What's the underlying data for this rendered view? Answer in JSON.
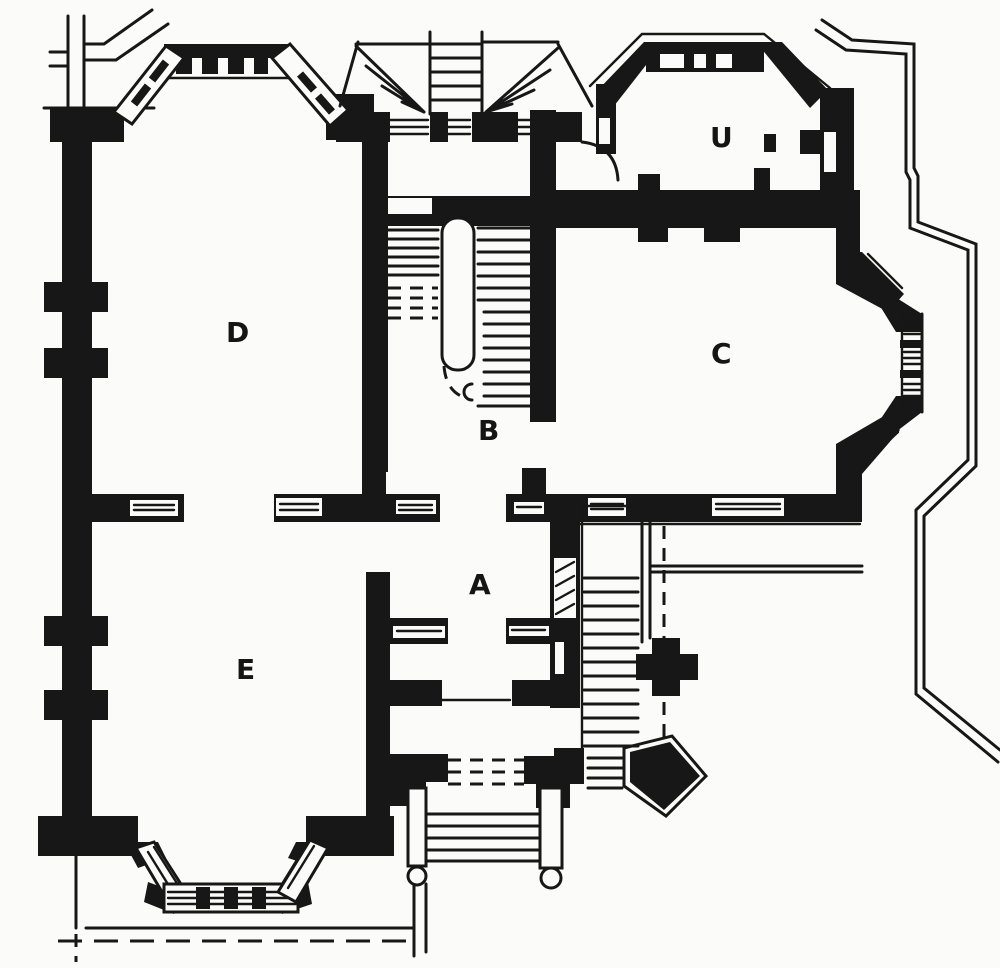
{
  "figure": {
    "kind": "architectural ground-floor plan, black-and-white engraved print",
    "palette": {
      "ink": "#171717",
      "paper": "#fbfbf9"
    }
  },
  "rooms": [
    {
      "id": "room-a",
      "label": "A"
    },
    {
      "id": "room-b",
      "label": "B"
    },
    {
      "id": "room-c",
      "label": "C"
    },
    {
      "id": "room-d",
      "label": "D"
    },
    {
      "id": "room-e",
      "label": "E"
    },
    {
      "id": "room-u",
      "label": "U"
    }
  ]
}
